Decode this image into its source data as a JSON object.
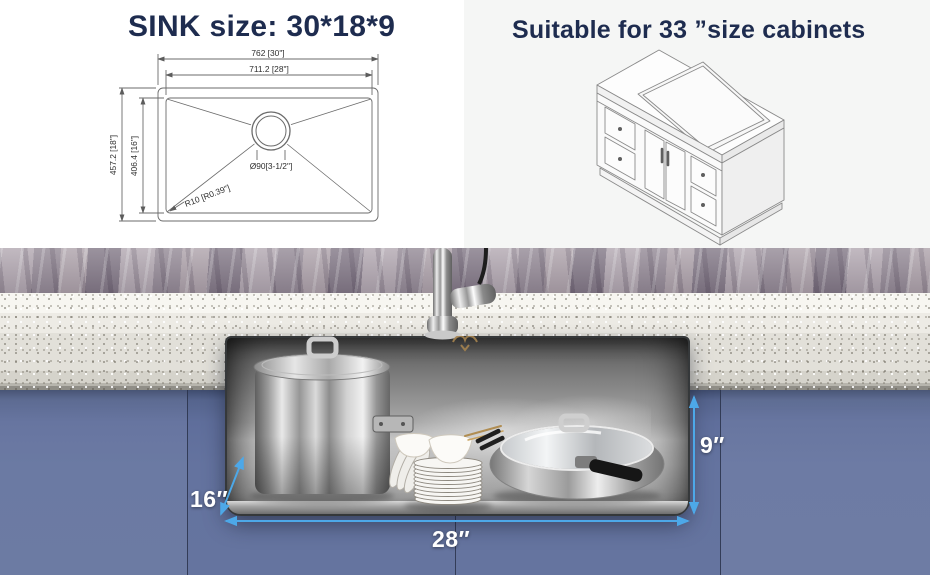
{
  "spec_panel": {
    "title": "SINK size: 30*18*9",
    "dims": {
      "outer_width": "762 [30\"]",
      "inner_width": "711.2 [28\"]",
      "outer_depth": "457.2 [18\"]",
      "inner_depth": "406.4 [16\"]",
      "drain": "Ø90[3-1/2\"]",
      "corner_radius": "R10 [R0.39\"]"
    }
  },
  "cabinet_panel": {
    "title": "Suitable for 33 ”size cabinets"
  },
  "photo": {
    "depth_label": "16″",
    "width_label": "28″",
    "height_label": "9″"
  },
  "icons": {
    "brand_logo": "bull-horns-logo"
  },
  "colors": {
    "title_navy": "#1e2c4f",
    "dimension_blue": "#4da8e8",
    "cabinet_blue": "#61709e",
    "drawing_line_gray": "#6b6b6b"
  }
}
